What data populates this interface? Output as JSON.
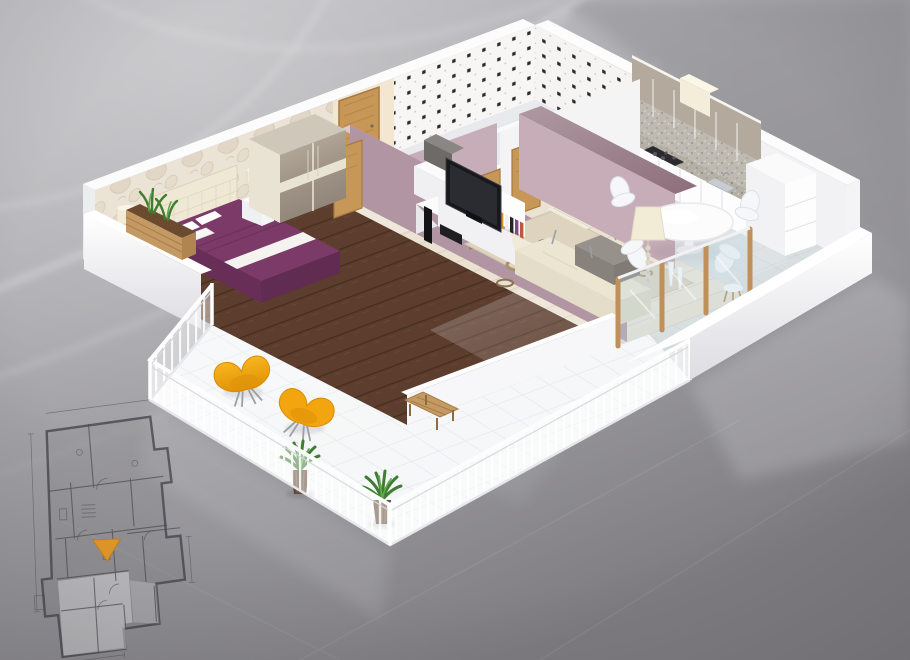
{
  "image": {
    "kind": "3d-apartment-floor-plan-render",
    "description": "Isometric 3D cutaway render of a one-bedroom apartment with wrap-around balcony, shown on a glossy grey studio background with a 2D blueprint sketch and an orange location marker at the lower left",
    "width": 910,
    "height": 660
  },
  "palette": {
    "background_top": "#bbbabe",
    "background_mid": "#a7a6aa",
    "background_bottom": "#828085",
    "swirl_light": "#ffffff",
    "wall_white": "#fafafb",
    "wall_shade": "#ececef",
    "wallpaper_base": "#ebe3d6",
    "wallpaper_motif": "#d6c9b7",
    "beige_wall": "#f3e7d2",
    "tile_white": "#f7f6f4",
    "tile_dot": "#2a2a2e",
    "mauve_wall": "#c7adb8",
    "mauve_wall_deep": "#b295a3",
    "plum_top": "#8d6e7a",
    "oak_wood": "#c79758",
    "oak_dark": "#a87a3e",
    "bedroom_floor": "#5c3d2e",
    "living_floor": "#ebe2d2",
    "dining_floor": "#d9dee1",
    "hallway_floor": "#efe8da",
    "bathroom_floor": "#e9eaed",
    "balcony_tile": "#f4f6f7",
    "rug_base": "#ddd3bf",
    "rug_ring_dark": "#6b5340",
    "rug_ring_tan": "#a8906e",
    "bed_purple": "#7b3a68",
    "bed_purple_dark": "#612c52",
    "bed_white": "#f5f3f0",
    "headboard_cream": "#efe8d4",
    "wardrobe_taupe": "#a89c8e",
    "wardrobe_band": "#e9e3d3",
    "sofa_cream": "#ece5d2",
    "ottoman_gray": "#96918b",
    "tv_black": "#17181c",
    "kitchen_upper": "#b3a99c",
    "kitchen_base": "#fdfdfe",
    "granite": "#b5b0a6",
    "chair_orange": "#f3a50f",
    "chair_orange_dark": "#d88c08",
    "plant_green": "#3e7d32",
    "plant_green_light": "#63a94c",
    "planter_wood": "#c49a64",
    "planter_dark": "#5f4a35",
    "lamp_cream": "#f2ecd7",
    "parapet_white": "#f6f6f8",
    "blueprint_line": "#3f3f48",
    "marker_orange": "#f09a18",
    "book_spines": [
      "#a33b36",
      "#2f5e9e",
      "#2e7d4f",
      "#d9952b",
      "#f2f0ec",
      "#24242a",
      "#7a4b8f",
      "#c0563c",
      "#3a8ea0"
    ]
  },
  "scene": {
    "rooms": [
      {
        "name": "bedroom",
        "objects": [
          "double-bed-purple-duvet",
          "tufted-headboard",
          "pillows",
          "sliding-door-wardrobe",
          "nightstand-lamps",
          "floral-wallpaper-wall",
          "dark-wood-floor",
          "planter-bench"
        ]
      },
      {
        "name": "living-room",
        "objects": [
          "cream-sectional-sofa",
          "barcelona-chair",
          "gray-ottoman-table",
          "white-tv-console",
          "flat-screen-tv",
          "speakers",
          "book-row",
          "circle-pattern-rug",
          "mauve-walls",
          "glass-balcony-wall"
        ]
      },
      {
        "name": "kitchen-dining",
        "objects": [
          "white-base-cabinets",
          "taupe-upper-cabinets",
          "granite-counter-backsplash",
          "range-hood",
          "cooktop",
          "sink",
          "tall-cabinet",
          "round-dining-table",
          "white-shell-chairs",
          "beaded-floor-lamp",
          "vases"
        ]
      },
      {
        "name": "bathroom",
        "objects": [
          "bathtub",
          "vanity-sink",
          "black-dot-tile-walls"
        ]
      },
      {
        "name": "hallway",
        "objects": [
          "oak-entrance-door",
          "leaning-oak-doors",
          "cabinet-with-gray-appliance",
          "beige-wall"
        ]
      },
      {
        "name": "balcony",
        "objects": [
          "white-railing",
          "two-orange-swan-chairs",
          "agave-planters",
          "wood-bench",
          "white-tile-floor",
          "solid-parapet"
        ]
      }
    ],
    "blueprint": {
      "style": "technical-2d-plan-sketch",
      "marker": "orange-triangle",
      "highlighted_unit": "lower-left-rooms"
    }
  }
}
